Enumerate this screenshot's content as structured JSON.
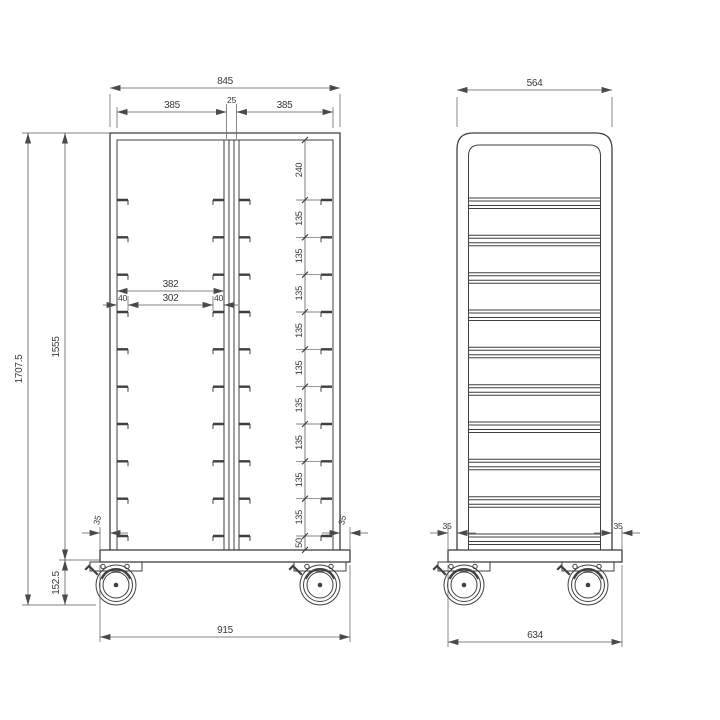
{
  "meta": {
    "background": "#ffffff",
    "line_color": "#3f3f3f"
  },
  "front_view": {
    "dims": {
      "overall_width": "845",
      "opening_left": "385",
      "center_gap": "25",
      "opening_right": "385",
      "overall_height": "1707.5",
      "frame_height": "1555",
      "caster_height": "152.5",
      "rail_outer_span": "382",
      "rail_inner_span": "302",
      "rail_hook_left": "40",
      "rail_hook_right": "40",
      "base_inset_left": "35",
      "base_inset_right": "35",
      "base_width": "915",
      "spacings": [
        "240",
        "135",
        "135",
        "135",
        "135",
        "135",
        "135",
        "135",
        "135",
        "135",
        "50"
      ]
    }
  },
  "side_view": {
    "dims": {
      "overall_width": "564",
      "base_inset_left": "35",
      "base_inset_right": "35",
      "base_width": "634"
    }
  }
}
